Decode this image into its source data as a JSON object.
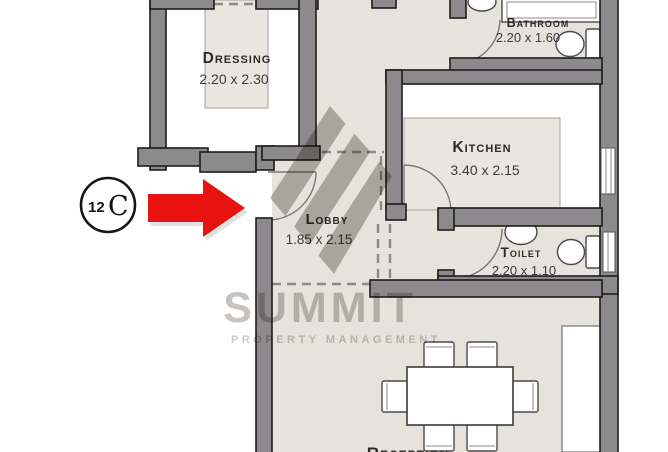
{
  "unit_badge": {
    "number": "12",
    "letter": "C"
  },
  "watermark": {
    "line1": "SUMMIT",
    "line2": "PROPERTY MANAGEMENT"
  },
  "rooms": {
    "dressing": {
      "label": "Dressing",
      "dims": "2.20 x 2.30"
    },
    "bathroom": {
      "label": "Bathroom",
      "dims": "2.20 x 1.60"
    },
    "kitchen": {
      "label": "Kitchen",
      "dims": "3.40 x 2.15"
    },
    "lobby": {
      "label": "Lobby",
      "dims": "1.85 x 2.15"
    },
    "toilet": {
      "label": "Toilet",
      "dims": "2.20 x 1.10"
    },
    "reception": {
      "label": "Reception"
    }
  },
  "colors": {
    "wall": "#8c8a8c",
    "floor": "#e6e2dc",
    "arrow_red": "#e81310",
    "watermark_gray": "#c0bdb9"
  }
}
